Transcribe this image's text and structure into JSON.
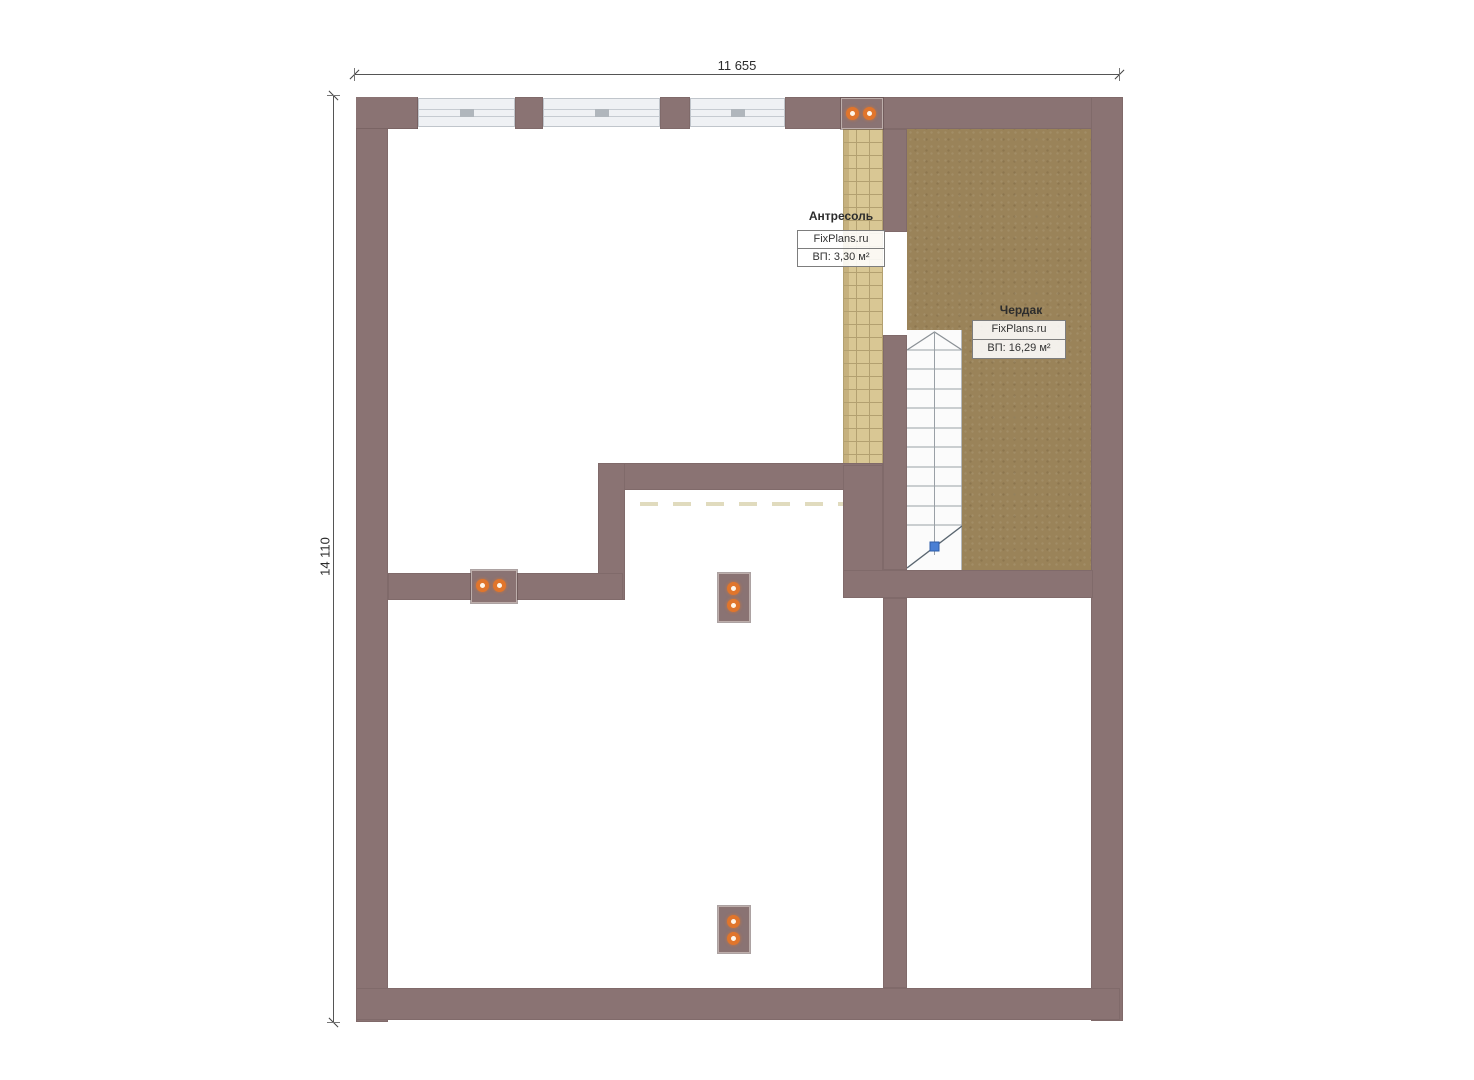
{
  "plan": {
    "dimensions": {
      "top": "11 655",
      "left": "14 110"
    },
    "rooms": {
      "mezzanine": {
        "name": "Антресоль",
        "watermark": "FixPlans.ru",
        "area": "ВП: 3,30 м²"
      },
      "attic": {
        "name": "Чердак",
        "watermark": "FixPlans.ru",
        "area": "ВП: 16,29 м²"
      }
    },
    "colors": {
      "wall": "#8a7373",
      "attic_floor": "#9a8359",
      "mezzanine_floor": "#d9c794",
      "mezzanine_grid": "#b3a070",
      "window_fill": "#eff1f4",
      "stair_line": "#9aa0a6",
      "direction_marker_blue": "#4a7fd4",
      "flue_ring_orange": "#e0752c"
    },
    "icons": {
      "flue_dot": "orange ring with white center (chimney flue)",
      "stair_direction_marker": "blue square on break line",
      "stair_up_chevron": "chevron at top of flight"
    }
  }
}
